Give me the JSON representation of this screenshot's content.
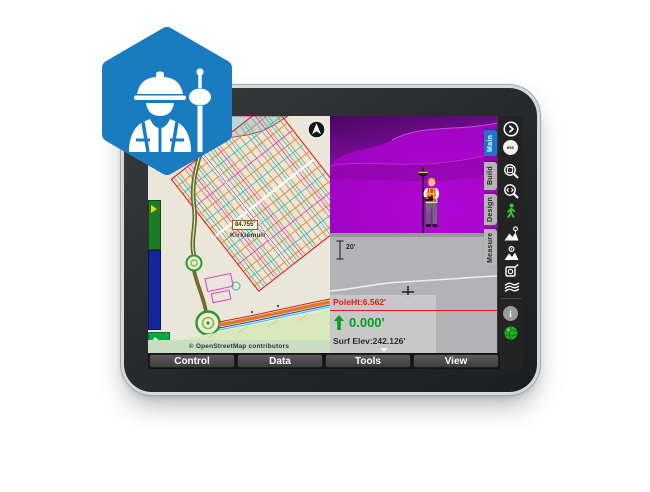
{
  "badge": {
    "shape": "hexagon",
    "color": "#1a7cc0",
    "icon": "surveyor-with-gnss-rover-icon"
  },
  "device": {
    "type": "tablet",
    "bezel_color": "#2b2c2f",
    "rim_color": "#d6d8da"
  },
  "map_view": {
    "attribution": "© OpenStreetMap contributors",
    "measurement_label": "84.755'",
    "place_label": "Kirklemuir",
    "compass_icon": "north-arrow-icon",
    "gnss_button_icon": "satellite-icon",
    "background_color": "#eae6da",
    "water_color": "#b9d6d8"
  },
  "view_3d": {
    "description": "3D terrain view with surveyor avatar",
    "terrain_color": "#a503c9",
    "hill_color": "#5c0a76"
  },
  "profile_view": {
    "scale_label": "20'",
    "pole_height": "PoleHt:6.562'",
    "cut_fill_arrow": "up-arrow-icon",
    "cut_fill_value": "0.000'",
    "surface_elevation": "Surf Elev:242.126'",
    "line_color": "#e21818",
    "value_color": "#00a31d",
    "background_color": "#b3b3b6"
  },
  "toolbar": {
    "tabs": [
      {
        "label": "Main",
        "active": true
      },
      {
        "label": "Build",
        "active": false
      },
      {
        "label": "Design",
        "active": false
      },
      {
        "label": "Measure",
        "active": false
      }
    ],
    "active_tab_color": "#1877d2",
    "esc_label": "esc",
    "info_label": "i",
    "buttons": [
      {
        "icon": "expand-chevron-icon"
      },
      {
        "icon": "esc-button"
      },
      {
        "icon": "zoom-window-icon"
      },
      {
        "icon": "zoom-dynamic-icon"
      },
      {
        "icon": "walk-navigation-icon"
      },
      {
        "icon": "stake-terrain-icon"
      },
      {
        "icon": "surface-inspect-icon"
      },
      {
        "icon": "level-instrument-icon"
      },
      {
        "icon": "surfaces-layers-icon"
      },
      {
        "icon": "info-button"
      },
      {
        "icon": "gnss-status-globe-icon"
      }
    ]
  },
  "menu": {
    "items": [
      "Control",
      "Data",
      "Tools",
      "View"
    ]
  }
}
